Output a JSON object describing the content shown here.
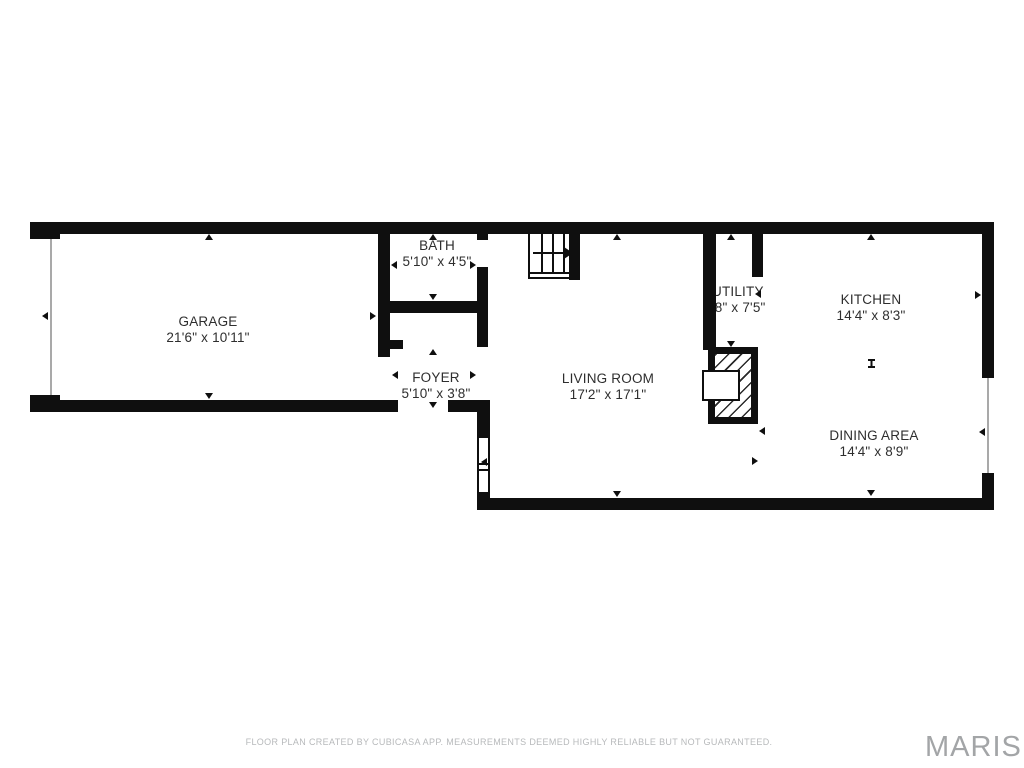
{
  "plan": {
    "rooms": {
      "garage": {
        "name": "GARAGE",
        "dims": "21'6\" x 10'11\""
      },
      "bath": {
        "name": "BATH",
        "dims": "5'10\" x 4'5\""
      },
      "foyer": {
        "name": "FOYER",
        "dims": "5'10\" x 3'8\""
      },
      "living_room": {
        "name": "LIVING ROOM",
        "dims": "17'2\" x 17'1\""
      },
      "utility": {
        "name": "UTILITY",
        "dims": "'8\" x 7'5\""
      },
      "kitchen": {
        "name": "KITCHEN",
        "dims": "14'4\" x 8'3\""
      },
      "dining_area": {
        "name": "DINING AREA",
        "dims": "14'4\" x 8'9\""
      }
    }
  },
  "footer": {
    "disclaimer": "FLOOR PLAN CREATED BY CUBICASA APP. MEASUREMENTS DEEMED HIGHLY RELIABLE BUT NOT GUARANTEED.",
    "brand": "MARIS"
  },
  "colors": {
    "wall": "#0f0f0f",
    "label_text": "#2e2e2e",
    "disclaimer_text": "#b7b9bb",
    "brand_text": "#a3a5a7",
    "background": "#ffffff"
  }
}
